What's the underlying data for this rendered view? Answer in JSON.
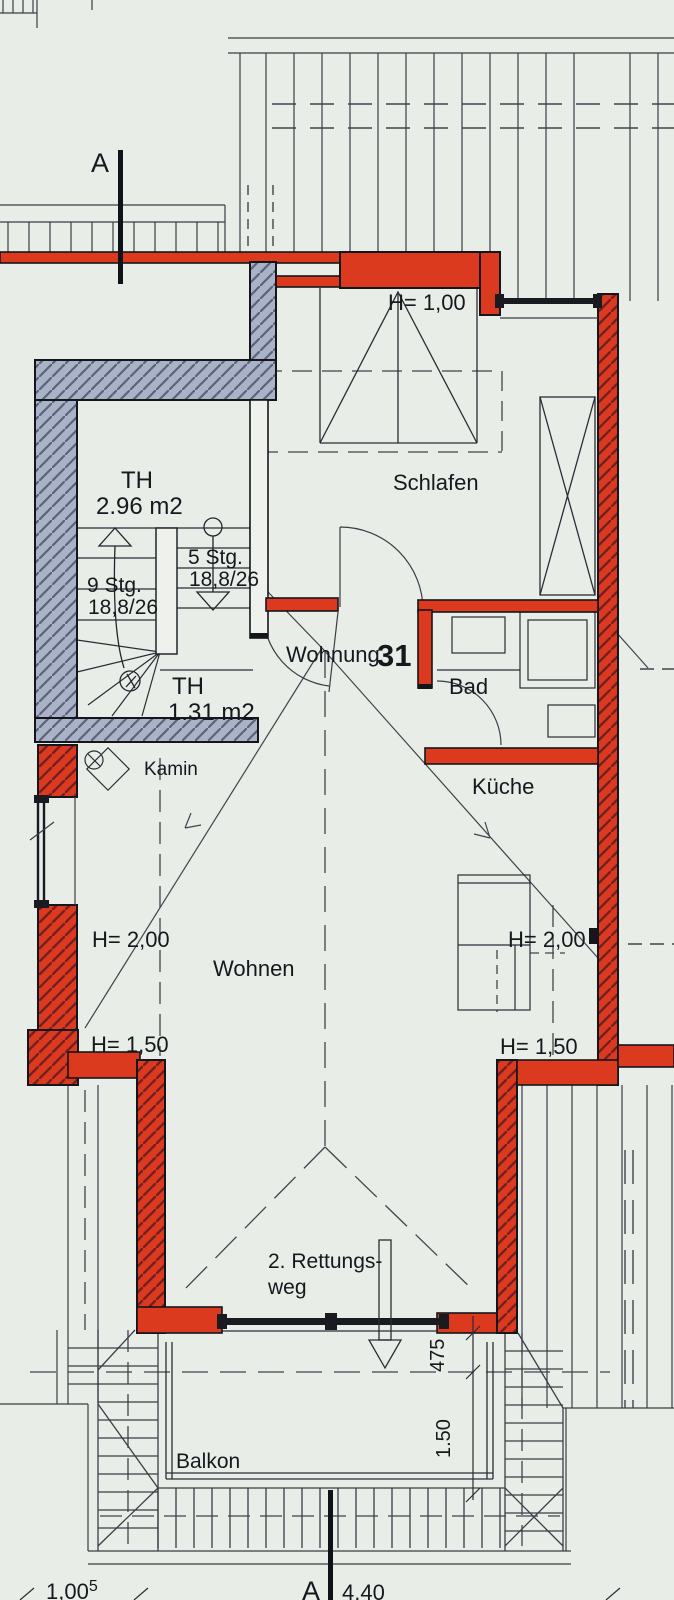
{
  "colors": {
    "background": "#e8ede8",
    "wall_red": "#dc3a1e",
    "wall_gray": "#a9b2c6",
    "line_dark": "#17181d"
  },
  "labels": {
    "section_a_top": "A",
    "section_a_bottom": "A",
    "h100": "H= 1,00",
    "th_upper": {
      "name": "TH",
      "area": "2.96 m2"
    },
    "th_lower": {
      "name": "TH",
      "area": "1.31 m2"
    },
    "schlafen": "Schlafen",
    "stairs_down": {
      "steps": "5 Stg.",
      "ratio": "18,8/26"
    },
    "stairs_up": {
      "steps": "9 Stg.",
      "ratio": "18,8/26"
    },
    "wohnung": "Wohnung",
    "wohnung_nr": "31",
    "bad": "Bad",
    "kamin": "Kamin",
    "kueche": "Küche",
    "h200_left": "H= 2,00",
    "h200_right": "H= 2,00",
    "wohnen": "Wohnen",
    "h150_left": "H= 1,50",
    "h150_right": "H= 1,50",
    "rettungsweg_line1": "2. Rettungs-",
    "rettungsweg_line2": "weg",
    "balkon": "Balkon",
    "dim_475": "475",
    "dim_150": "1.50",
    "dim_100": "1,00",
    "dim_100_sup": "5",
    "dim_440": "4,40"
  }
}
